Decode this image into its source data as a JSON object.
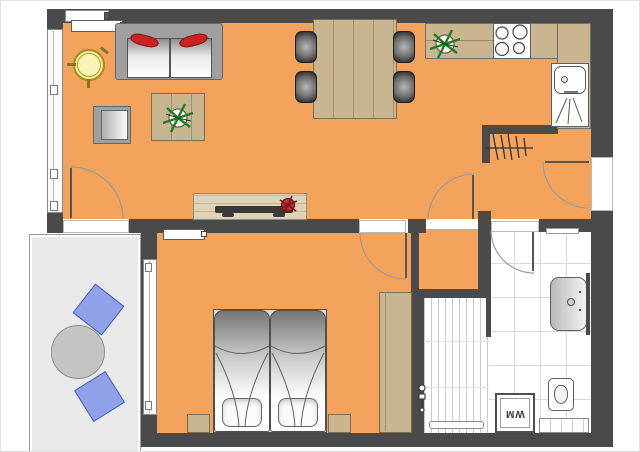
{
  "meta": {
    "type": "apartment floor plan",
    "view": "top-down architectural drawing"
  },
  "labels": {
    "washing_machine": "WM"
  },
  "colors": {
    "wall": "#4a4a4a",
    "floor": "#f4a35c",
    "wood": "#c9b58f",
    "wood_dark_line": "#a3916e",
    "wood_light": "#ded3b6",
    "balcony_floor": "#e9e9e9",
    "chair_blue": "#8fa1e8",
    "chair_blue_border": "#4a5fbf",
    "pillow_red": "#cc2222",
    "plant_green": "#1e7d1e",
    "plant_red": "#a51f1f",
    "table_yellow": "#f6ec9b",
    "table_yellow_border": "#a58a1e",
    "gray_furniture": "#9f9f9f",
    "tile_line": "#d8d8d8",
    "fixture_border": "#5f5f5f",
    "arc": "#9a9a9a"
  },
  "furniture_icons": [
    "sofa",
    "red-pillow",
    "coffee-table",
    "potted-plant",
    "armchair",
    "side-table",
    "tv-sideboard",
    "tv",
    "dining-table",
    "dining-chair",
    "kitchen-counter",
    "stove",
    "kitchen-sink",
    "coat-rack",
    "door-swing",
    "window",
    "radiator",
    "double-bed",
    "bed-pillow",
    "nightstand",
    "wardrobe",
    "shower",
    "shower-valve",
    "washbasin",
    "toilet",
    "washing-machine",
    "bathroom-radiator",
    "balcony-table",
    "balcony-chair"
  ]
}
